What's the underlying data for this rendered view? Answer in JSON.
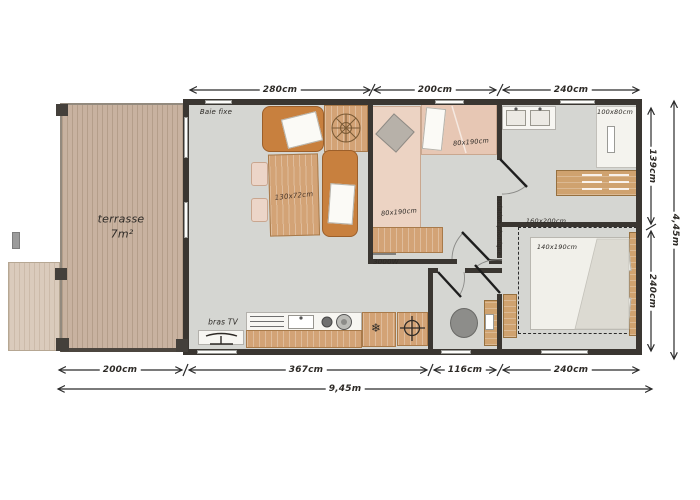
{
  "plan": {
    "title": "floor-plan-mobile-home",
    "palette": {
      "wall": "#3a3631",
      "floor": "#d5d6d2",
      "terrace_wood": "#c8b2a0",
      "furniture_wood": "#d3a376",
      "sofa": "#c8803e",
      "label_ink": "#2d2a26"
    },
    "terrace": {
      "name": "terrasse",
      "area": "7m²"
    },
    "living": {
      "bay_label": "Baie fixe",
      "table_label": "130x72cm",
      "tv_label": "bras TV"
    },
    "bedroom2": {
      "bed_top_label": "80x190cm",
      "bed_left_label": "80x190cm",
      "heater_label": "3000W"
    },
    "bathroom": {
      "shower_label": "100x80cm"
    },
    "bedroom1": {
      "zone_label": "160x200cm",
      "bed_label": "140x190cm"
    },
    "wall_note": "Isolation phonique",
    "dims": {
      "top": [
        "280cm",
        "200cm",
        "240cm"
      ],
      "right": [
        "139cm",
        "240cm"
      ],
      "right_total": "4,45m",
      "bottom": [
        "200cm",
        "367cm",
        "116cm",
        "240cm"
      ],
      "bottom_total": "9,45m"
    }
  }
}
